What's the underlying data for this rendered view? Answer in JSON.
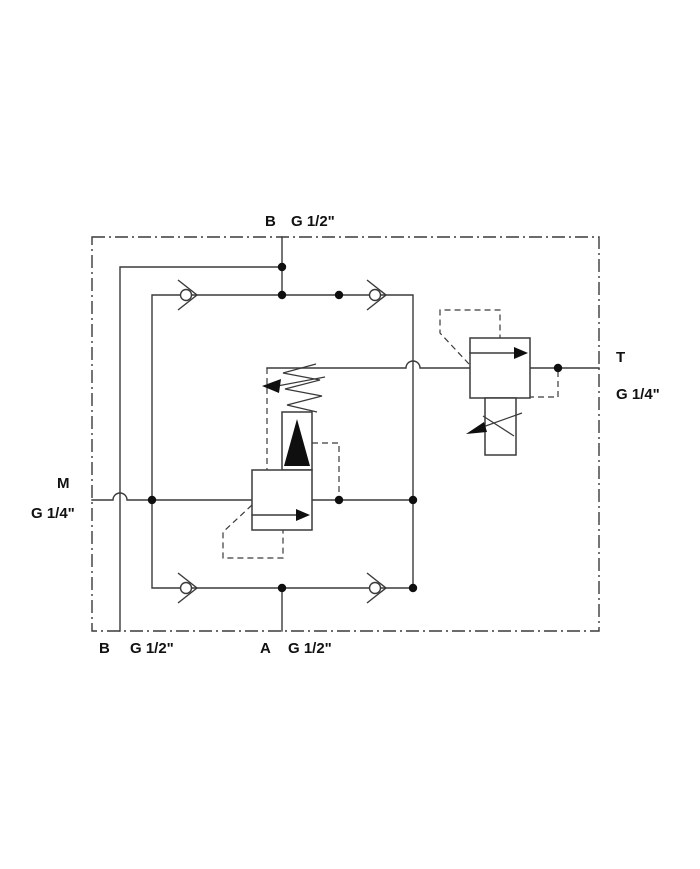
{
  "meta": {
    "description": "Hydraulic schematic of a cross-over relief valve manifold block",
    "drawing_type": "hydraulic circuit symbol drawing"
  },
  "colors": {
    "background": "#ffffff",
    "line": "#3a3a3a",
    "symbol_fill": "#0f0f0f",
    "label": "#111111"
  },
  "ports": {
    "b_top": {
      "label": "B",
      "size": "G 1/2\""
    },
    "b_bottom": {
      "label": "B",
      "size": "G 1/2\""
    },
    "a_bottom": {
      "label": "A",
      "size": "G 1/2\""
    },
    "m_left": {
      "label": "M",
      "size": "G 1/4\""
    },
    "t_right": {
      "label": "T",
      "size": "G 1/4\""
    }
  },
  "components": {
    "enclosure": "manifold boundary (dash-dot envelope)",
    "check_valves": [
      "top-left",
      "top-right",
      "bottom-left",
      "bottom-right"
    ],
    "main_relief_valve": "pilot-operated relief valve with adjustable spring",
    "pilot_relief_valve": "relief cartridge to tank port T"
  }
}
